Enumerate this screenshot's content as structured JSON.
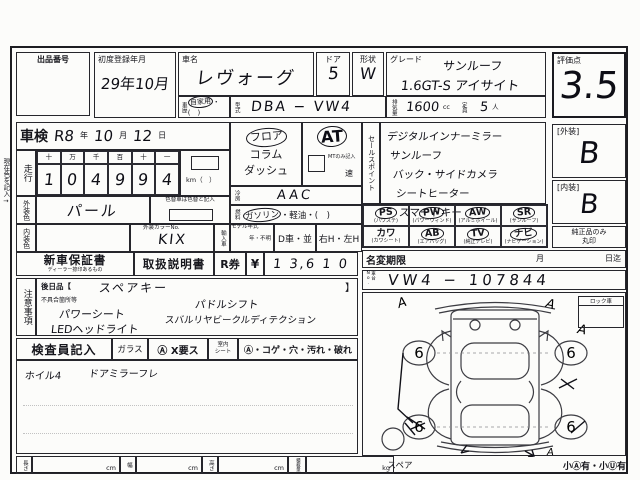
{
  "page": {
    "side_note": "現在色を記入→"
  },
  "header": {
    "lot_label": "出品番号",
    "first_reg_label": "初度登録年月",
    "first_reg_value": "29年10月",
    "car_name_label": "車名",
    "car_name_value": "レヴォーグ",
    "history_label": "車歴",
    "history_selected": "自家用",
    "history_rest": "・(　)",
    "model_code_label": "型式",
    "model_code_value": "DBA − VW4",
    "door_label": "ドア",
    "door_value": "5",
    "shape_label": "形状",
    "shape_value": "W",
    "grade_label": "グレード",
    "grade_line1": "サンルーフ",
    "grade_line2": "1.6GT-S アイサイト",
    "displacement_label": "排気量",
    "displacement_value": "1600",
    "displacement_unit": "cc",
    "capacity_label": "定員",
    "capacity_value": "5",
    "capacity_unit": "人",
    "score_label": "評価点",
    "score_value": "3.5"
  },
  "shaken": {
    "label": "車検",
    "era": "R8",
    "y": "年",
    "month": "10",
    "m": "月",
    "day": "12",
    "d": "日"
  },
  "mileage": {
    "label": "走行",
    "headers": [
      "十",
      "万",
      "千",
      "百",
      "十",
      "一"
    ],
    "digits": [
      "1",
      "0",
      "4",
      "9",
      "9",
      "4"
    ],
    "unit": "km（　）"
  },
  "colors": {
    "ext_label": "外装色",
    "ext_value": "パール",
    "change_note": "色替車は色替と記入",
    "int_label": "内装色",
    "color_no_label": "外装カラーNo.",
    "color_no_value": "KIX",
    "import_label": "輸入車",
    "model_year_label": "モデル年式",
    "model_year_value": "年・不明",
    "d_car": "D車・並",
    "handle": "右H・左H"
  },
  "drive": {
    "pos_selected": "フロア",
    "pos_opt2": "コラム",
    "pos_opt3": "ダッシュ",
    "at": "AT",
    "mt_note": "MTのみ記入",
    "speed": "速",
    "ac_label": "冷房",
    "ac_value": "AAC",
    "fuel_label": "燃料",
    "fuel_selected": "ガソリン",
    "fuel_rest": "・軽油・(　)"
  },
  "sales": {
    "label": "セールスポイント",
    "lines": [
      "デジタルインナーミラー",
      "サンルーフ",
      "バック・サイドカメラ",
      "シートヒーター",
      "スマートキー"
    ]
  },
  "equipment": {
    "items": [
      {
        "code": "PS",
        "sub": "(パワステ)",
        "circled": true
      },
      {
        "code": "PW",
        "sub": "(パワーウィンド)",
        "circled": true
      },
      {
        "code": "AW",
        "sub": "(アルミホイール)",
        "circled": true
      },
      {
        "code": "SR",
        "sub": "(サンルーフ)",
        "circled": true
      },
      {
        "code": "カワ",
        "sub": "(カワシート)",
        "circled": false
      },
      {
        "code": "AB",
        "sub": "(エアバッグ)",
        "circled": true
      },
      {
        "code": "TV",
        "sub": "(純正テレビ)",
        "circled": true
      },
      {
        "code": "ナビ",
        "sub": "(ナビゲーション)",
        "circled": true
      }
    ]
  },
  "grades": {
    "ext_label": "[外装]",
    "ext_value": "B",
    "int_label": "[内装]",
    "int_value": "B",
    "genuine_line1": "純正品のみ",
    "genuine_line2": "丸印"
  },
  "name_change": {
    "label": "名変期限",
    "month": "月",
    "until": "日迄"
  },
  "chassis": {
    "label": "車台No.",
    "value": "VW4 − 107844"
  },
  "docs": {
    "warranty_label": "新車保証書",
    "warranty_sub": "ディーラー捺印あるもの",
    "manual_label": "取扱説明書",
    "ticket_label": "R券",
    "yen": "¥",
    "amount": "1 3,6 1 0"
  },
  "notes": {
    "label": "注意事項",
    "later_label": "後日品【",
    "later_value": "スペアキー",
    "later_close": "】",
    "defect_label": "不具合箇所等",
    "left_lines": [
      "パワーシート",
      "LEDヘッドライト"
    ],
    "right_lines": [
      "パドルシフト",
      "スバルリヤビークルディテクション"
    ]
  },
  "inspector": {
    "label": "検査員記入",
    "glass_label": "ガラス",
    "glass_note": "Ⓐ X要ス",
    "seat_label1": "室内",
    "seat_label2": "シート",
    "seat_note": "Ⓐ・コゲ・穴・汚れ・破れ",
    "remark1": "ホイル4",
    "remark2": "ドアミラーフレ"
  },
  "diagram": {
    "lock_label": "ロック車",
    "wheel_fl": "6",
    "wheel_fr": "6",
    "wheel_rl": "6",
    "wheel_rr": "6",
    "mark_a": "A",
    "spare_label": "スペア",
    "bottom_note": "小Ⓐ有・小Ⓤ有"
  },
  "dims": {
    "length_label": "長さ",
    "length_unit": "cm",
    "width_label": "幅",
    "width_unit": "cm",
    "height_label": "高さ",
    "height_unit": "cm",
    "load_label": "積載量",
    "load_unit": "kg"
  }
}
